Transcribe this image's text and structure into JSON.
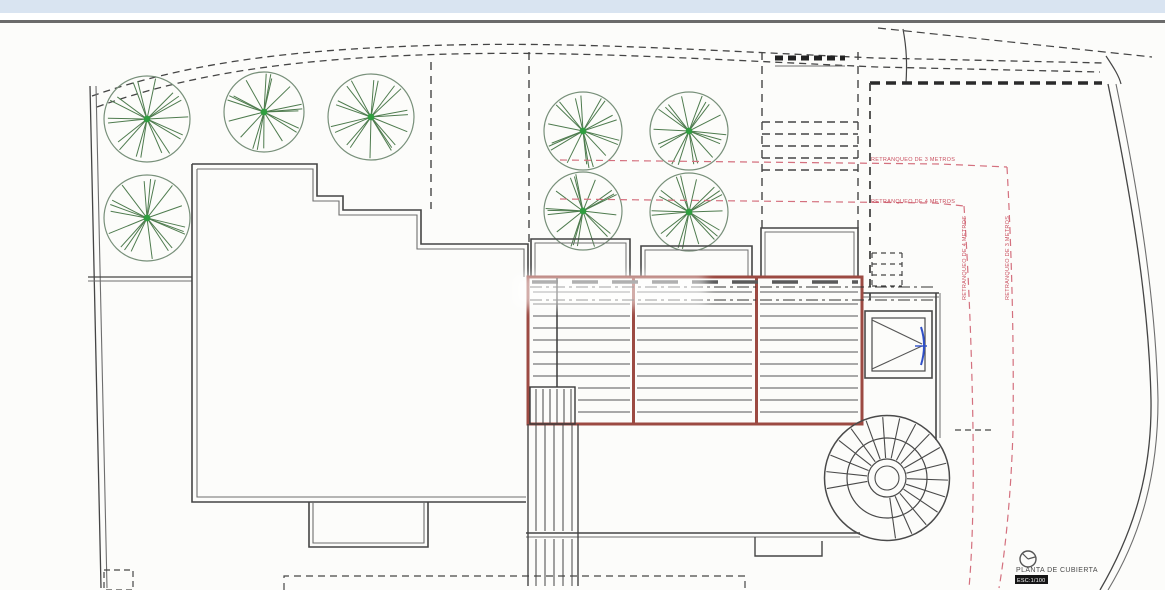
{
  "plan": {
    "labels": {
      "retranqueo_3m_h": "RETRANQUEO DE 3 METROS",
      "retranqueo_4m_h": "RETRANQUEO DE 4 METROS",
      "retranqueo_4m_v": "RETRANQUEO DE 4 METROS",
      "retranqueo_3m_v": "RETRANQUEO DE 3 METROS",
      "title": "PLANTA DE CUBIERTA",
      "scale_badge": "ESC:1/100"
    },
    "colors": {
      "top_bar": "#d9e4f1",
      "rule_gray": "#6b6b6b",
      "paper": "#fcfcfa",
      "line": "#454545",
      "line_light": "#6e6e6e",
      "tree_stroke": "#4e7b4e",
      "tree_rim": "#78907a",
      "tree_center": "#2f9e3f",
      "terrace_red": "#9c4a42",
      "setback_pink": "#d4707e",
      "setback_text": "#c94f5f",
      "skylight_blue": "#3050c8"
    }
  }
}
